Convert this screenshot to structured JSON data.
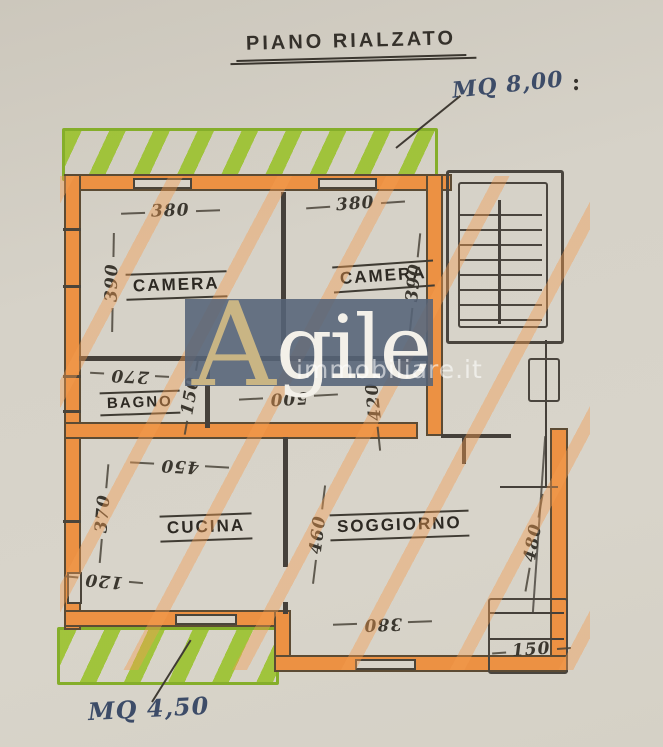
{
  "title": "PIANO RIALZATO",
  "annotations": {
    "terrace_top_area": "MQ 8,00",
    "punctuation_mark": ":",
    "terrace_bottom_area": "MQ 4,50"
  },
  "watermark": {
    "initial": "A",
    "rest": "gile",
    "site": "immobiliare.it"
  },
  "rooms": {
    "camera_left": {
      "label": "CAMERA",
      "width": "380",
      "depth": "390"
    },
    "camera_right": {
      "label": "CAMERA",
      "width": "380",
      "depth": "390"
    },
    "bagno": {
      "label": "BAGNO",
      "width": "270",
      "depth": "150"
    },
    "corridoio": {
      "width": "500",
      "depth": "420"
    },
    "cucina": {
      "label": "CUCINA",
      "width": "450",
      "depth": "370",
      "door_opening": "120"
    },
    "soggiorno": {
      "label": "SOGGIORNO",
      "depth": "460",
      "window_width": "380",
      "side": "480"
    },
    "ingresso": {
      "width": "150"
    }
  },
  "colors": {
    "paper": "#d5d1c7",
    "wall_highlight": "#ec9143",
    "floor_stripe": "#f39c50",
    "terrace_green": "#97c123",
    "pencil": "#45403a",
    "ink_blue": "#3d4c68",
    "watermark_bg": "#556377",
    "watermark_gold": "#c9b584"
  }
}
